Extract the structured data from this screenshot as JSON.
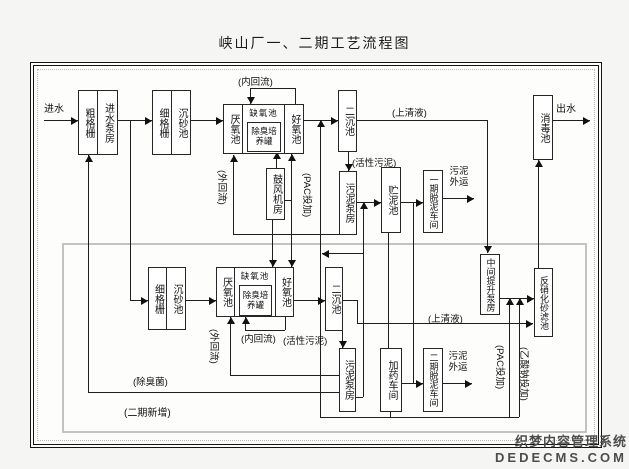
{
  "title": "峡山厂一、二期工艺流程图",
  "watermark": {
    "line1": "织梦内容管理系统",
    "line2": "DEDECMS.COM"
  },
  "io": {
    "inflow": "进水",
    "outflow": "出水"
  },
  "phase1": {
    "coarse_screen": "粗格栅",
    "inlet_pump_house": "进水泵房",
    "fine_screen": "细格栅",
    "grit_chamber": "沉砂池",
    "anaerobic_tank": "厌氧池",
    "anoxic_tank": "缺氧池",
    "deodor_culture_tank": "除臭培养罐",
    "aerobic_tank": "好氧池",
    "secondary_clarifier": "二沉池",
    "blower_house": "鼓风机房",
    "sludge_pump_house": "污泥泵房",
    "sludge_storage_tank": "贮泥池",
    "phase1_dewatering": "一期脱泥车间",
    "disinfection_tank": "消毒池",
    "internal_reflux": "(内回流)",
    "external_reflux": "(外回流)",
    "pac_dosing": "(PAC投加)",
    "activated_sludge": "(活性污泥)",
    "supernatant": "(上清液)",
    "sludge_out": "污泥外运"
  },
  "phase2": {
    "fine_screen": "细格栅",
    "grit_chamber": "沉砂池",
    "anaerobic_tank": "厌氧池",
    "anoxic_tank": "缺氧池",
    "deodor_culture_tank": "除臭培养罐",
    "aerobic_tank": "好氧池",
    "secondary_clarifier": "二沉池",
    "sludge_pump_house": "污泥泵房",
    "dosing_workshop": "加药车间",
    "phase2_dewatering": "二期脱泥车间",
    "intermediate_lift_pump_house": "中间提升泵房",
    "denitrification_sand_filter": "反硝化砂滤池",
    "internal_reflux": "(内回流)",
    "external_reflux": "(外回流)",
    "pac_dosing": "(PAC投加)",
    "sodium_acetate_dosing": "(乙酸钠投加)",
    "activated_sludge": "(活性污泥)",
    "supernatant": "(上清液)",
    "sludge_out": "污泥外运",
    "deodor_bacteria": "(除臭菌)",
    "region_tag": "(二期新增)"
  }
}
